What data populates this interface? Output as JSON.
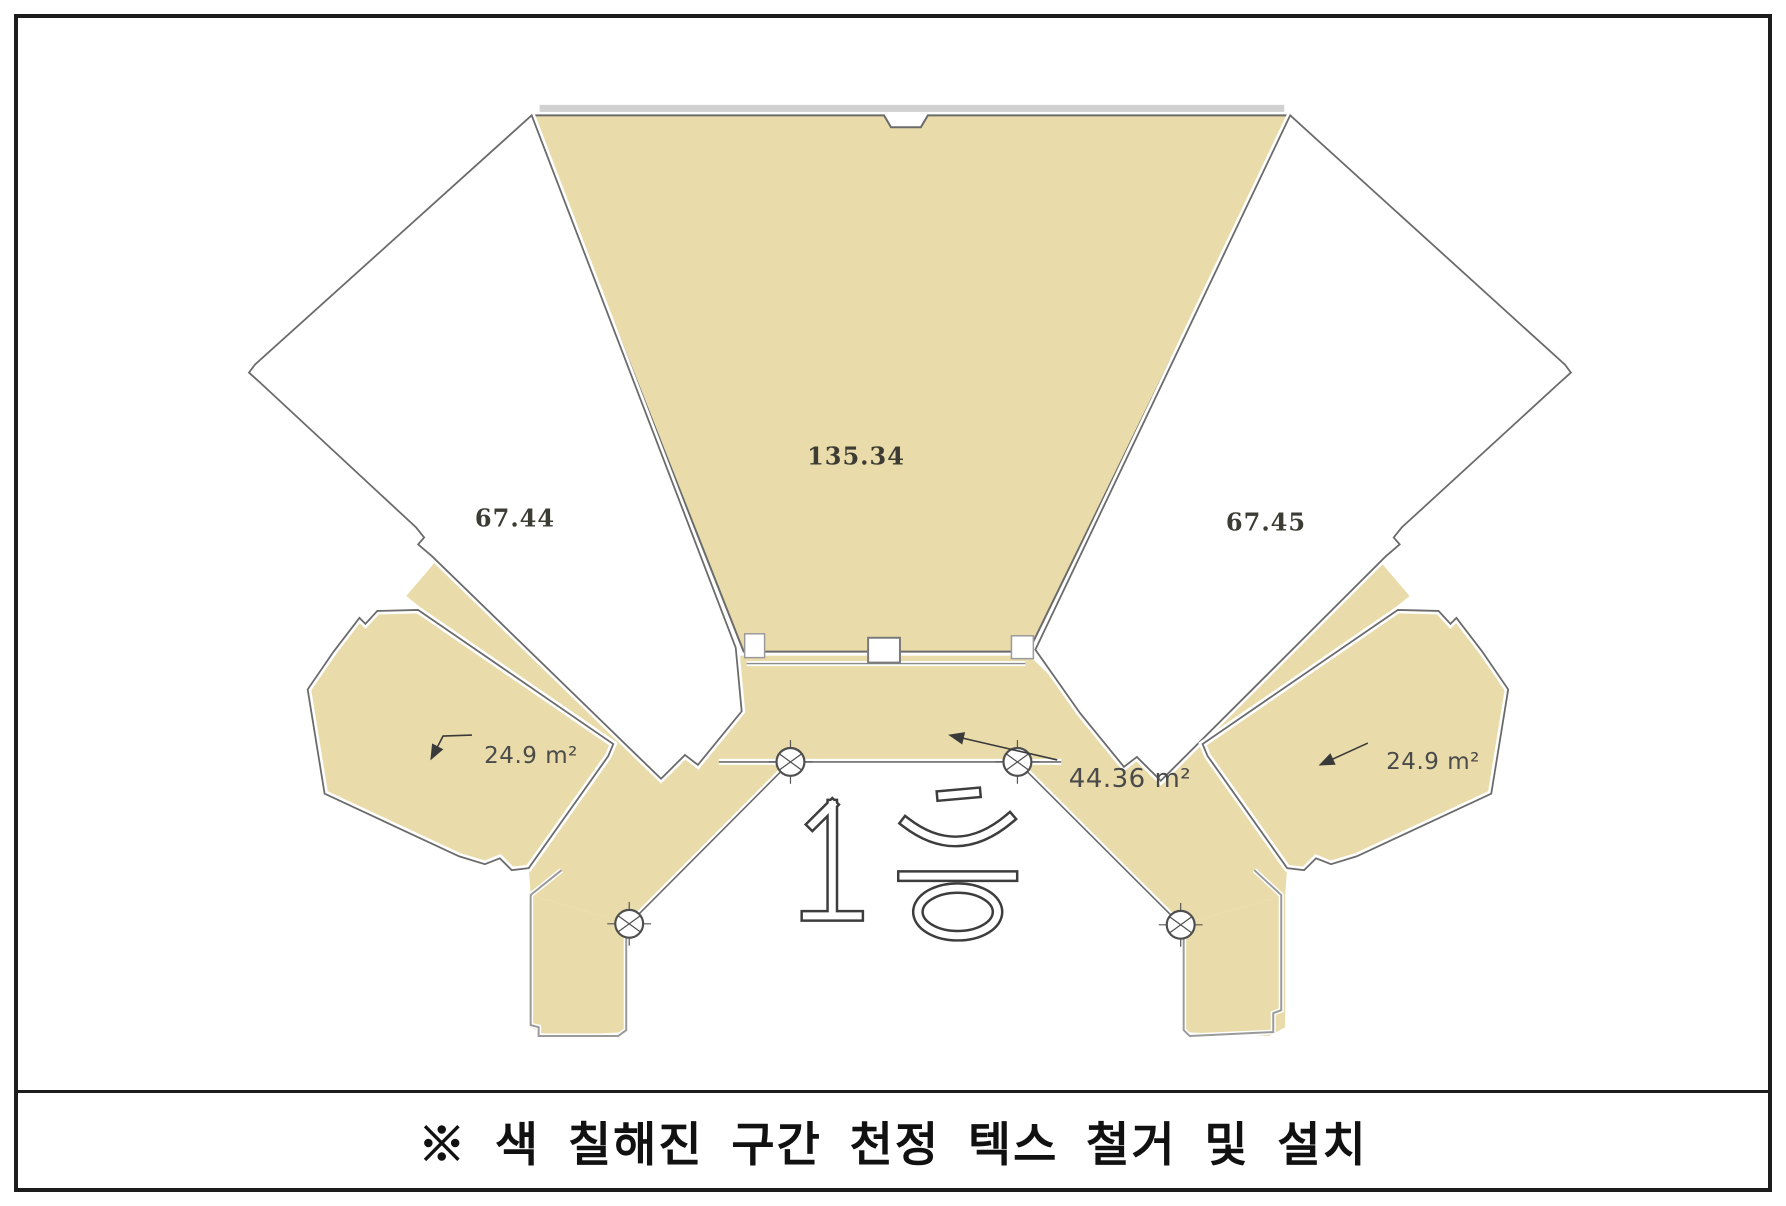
{
  "document": {
    "type": "floor-plan-sheet",
    "caption": "※ 색 칠해진 구간 천정 텍스 철거 및 설치",
    "floor_label": "1층"
  },
  "plan": {
    "areas": {
      "center_hall": {
        "value": "135.34",
        "highlighted": true
      },
      "left_wing": {
        "value": "67.44",
        "highlighted": false
      },
      "right_wing": {
        "value": "67.45",
        "highlighted": false
      },
      "corridor": {
        "value": "44.36 m²",
        "highlighted": true
      },
      "left_pod": {
        "value": "24.9 m²",
        "highlighted": true
      },
      "right_pod": {
        "value": "24.9 m²",
        "highlighted": true
      }
    },
    "symbols": {
      "column_count": 4,
      "column_symbol": "circle-crosshair"
    },
    "colors": {
      "highlight_fill": "#e9dcaa",
      "wall_line": "#6b6b6b",
      "light_band": "#d0d0d0",
      "border": "#1c1c1c",
      "label_text": "#3a3a3a"
    }
  }
}
